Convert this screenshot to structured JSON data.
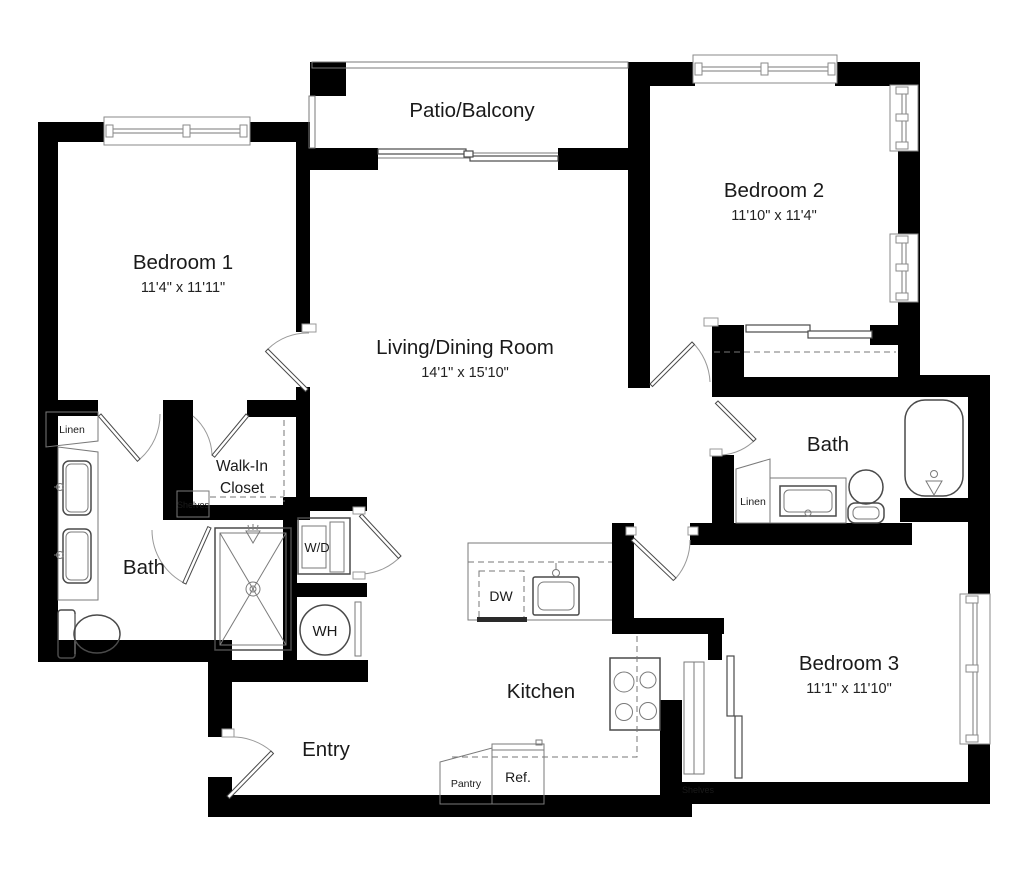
{
  "plan": {
    "background": "#ffffff",
    "wall_color": "#000000",
    "fixture_color": "#4a4a4a",
    "text_color": "#1a1a1a",
    "rooms": {
      "patio": {
        "name": "Patio/Balcony"
      },
      "bedroom1": {
        "name": "Bedroom 1",
        "dimensions": "11'4\" x 11'11\""
      },
      "bedroom2": {
        "name": "Bedroom 2",
        "dimensions": "11'10\" x 11'4\""
      },
      "bedroom3": {
        "name": "Bedroom 3",
        "dimensions": "11'1\" x 11'10\""
      },
      "living_dining": {
        "name": "Living/Dining Room",
        "dimensions": "14'1\" x 15'10\""
      },
      "kitchen": {
        "name": "Kitchen"
      },
      "entry": {
        "name": "Entry"
      },
      "bath_main": {
        "name": "Bath"
      },
      "bath_second": {
        "name": "Bath"
      },
      "walk_in_closet": {
        "line1": "Walk-In",
        "line2": "Closet"
      }
    },
    "fixtures": {
      "washer_dryer": "W/D",
      "water_heater": "WH",
      "dishwasher": "DW",
      "refrigerator": "Ref.",
      "pantry": "Pantry",
      "linen_main": "Linen",
      "linen_second": "Linen",
      "shelves_closet": "Shelves",
      "shelves_bedroom3": "Shelves"
    }
  }
}
